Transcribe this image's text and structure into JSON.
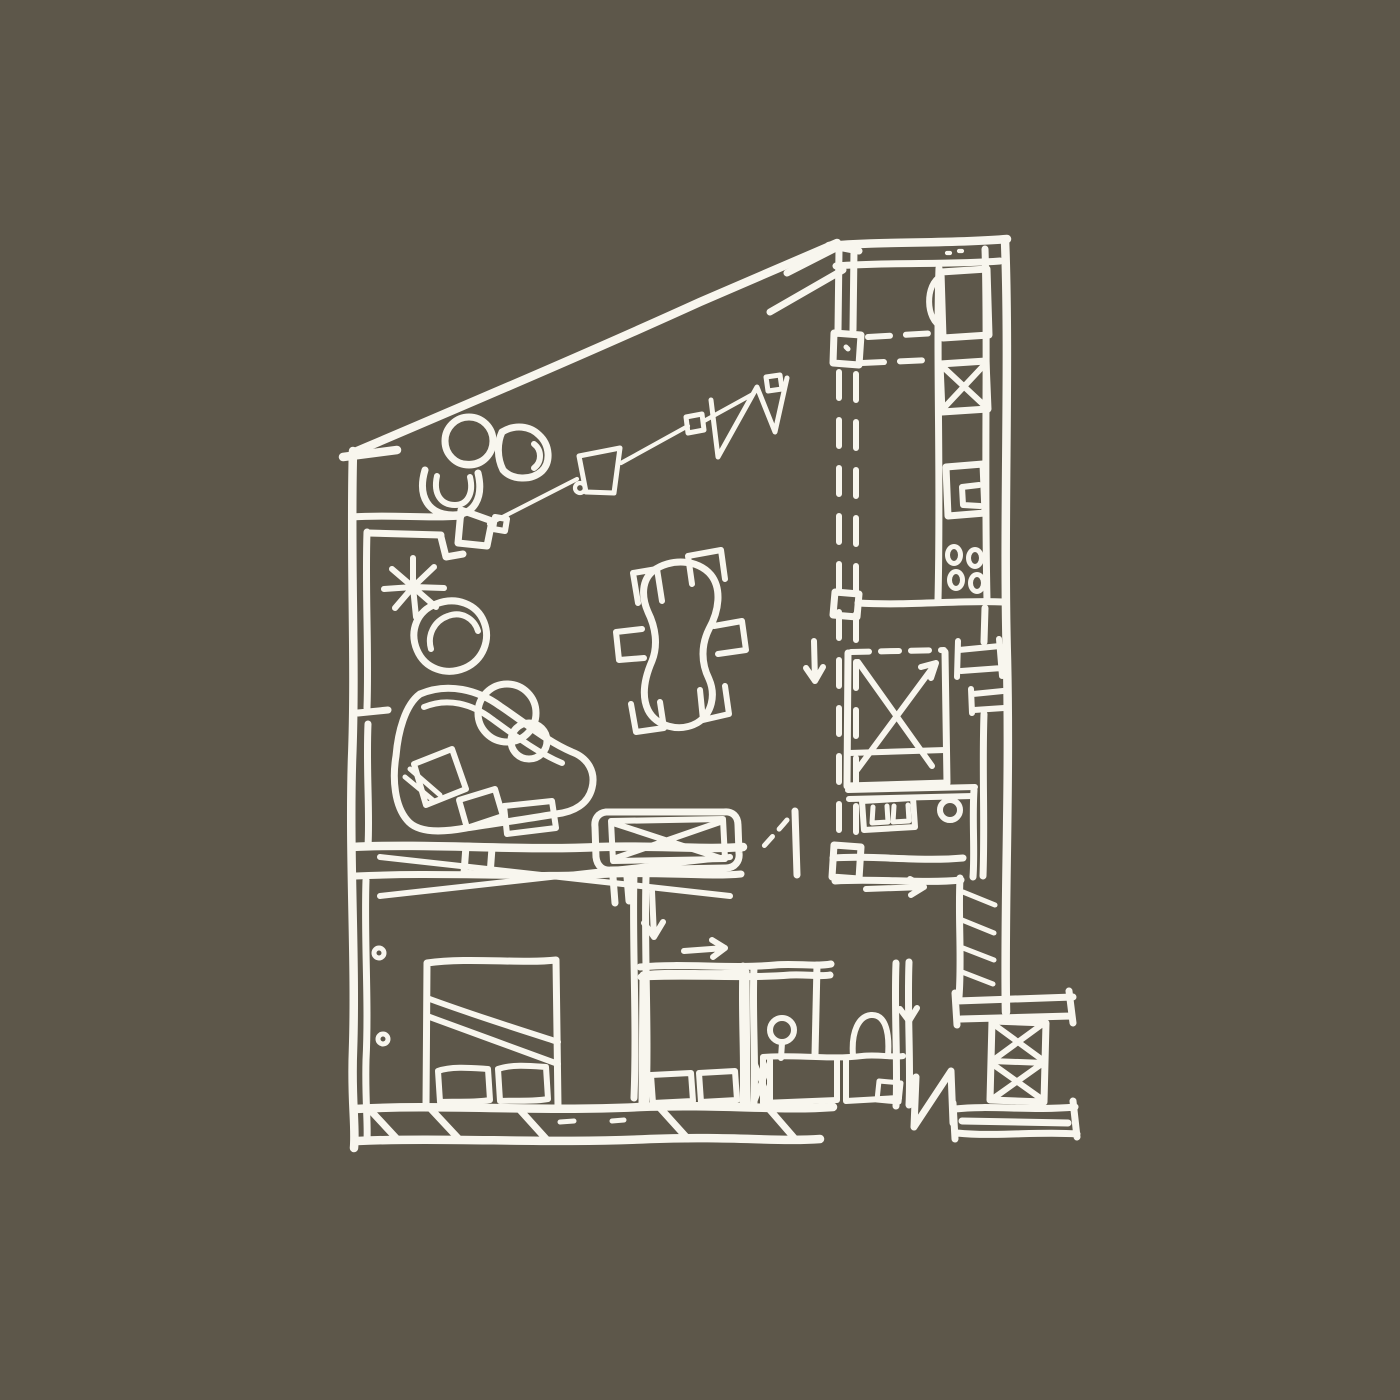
{
  "meta": {
    "description": "Hand-drawn architectural floor plan sketch, white ink on olive-brown background"
  },
  "canvas": {
    "width": 1400,
    "height": 1400
  },
  "colors": {
    "background": "#5D574A",
    "ink": "#F8F6EE"
  },
  "elements": {
    "rooms": [
      "living-dining-area",
      "kitchen",
      "bedroom-right",
      "bedroom-left",
      "bedroom-middle",
      "bathroom",
      "entry"
    ],
    "furniture": [
      "dining-table",
      "six-dining-chairs",
      "curved-sofa",
      "seat-cushions",
      "armchair",
      "round-side-tables",
      "round-lounge-chair",
      "d-lounge-chair",
      "u-lounge-chair",
      "plant",
      "wall-console",
      "media-unit-x",
      "kitchen-sink",
      "dishwasher-x",
      "oven",
      "cooktop-burners",
      "double-bed-x",
      "single-bed-left",
      "single-bed-middle",
      "pillows",
      "dresser-drawers",
      "stool",
      "washbasin",
      "vanity-counter",
      "toilet",
      "radiator",
      "wardrobe-x-column"
    ],
    "annotations": [
      "circulation-arrow-down",
      "circulation-arrow-right",
      "door-swing-dashes",
      "dashed-partition-lines",
      "pendant-light-track",
      "zigzag-mark",
      "entry-door-leaf",
      "wall-hatching",
      "window-hinges"
    ]
  }
}
